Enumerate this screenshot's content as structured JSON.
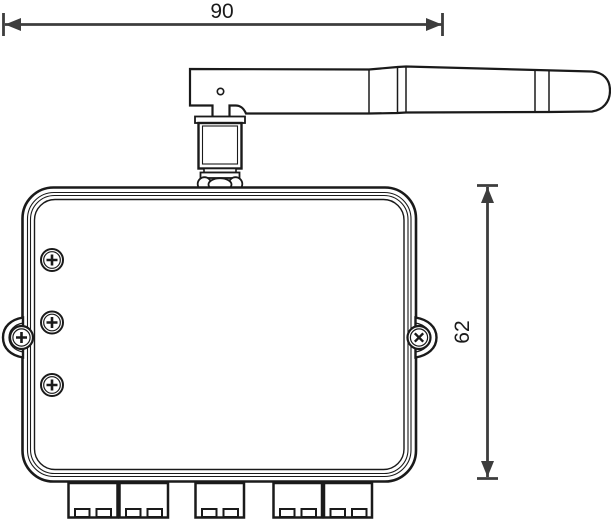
{
  "colors": {
    "ink": "#1a1a1a",
    "dim": "#3d3d3d",
    "paper": "#ffffff"
  },
  "drawing": {
    "type": "technical-dimension-drawing",
    "subject": "wireless module enclosure with antenna",
    "dimensions": {
      "overall_width": {
        "label": "90",
        "orientation": "horizontal"
      },
      "body_height": {
        "label": "62",
        "orientation": "vertical"
      }
    },
    "parts": {
      "panel_screws": 3,
      "mounting_ears": 2,
      "terminal_blocks": 5,
      "antenna_segments": 3
    }
  }
}
